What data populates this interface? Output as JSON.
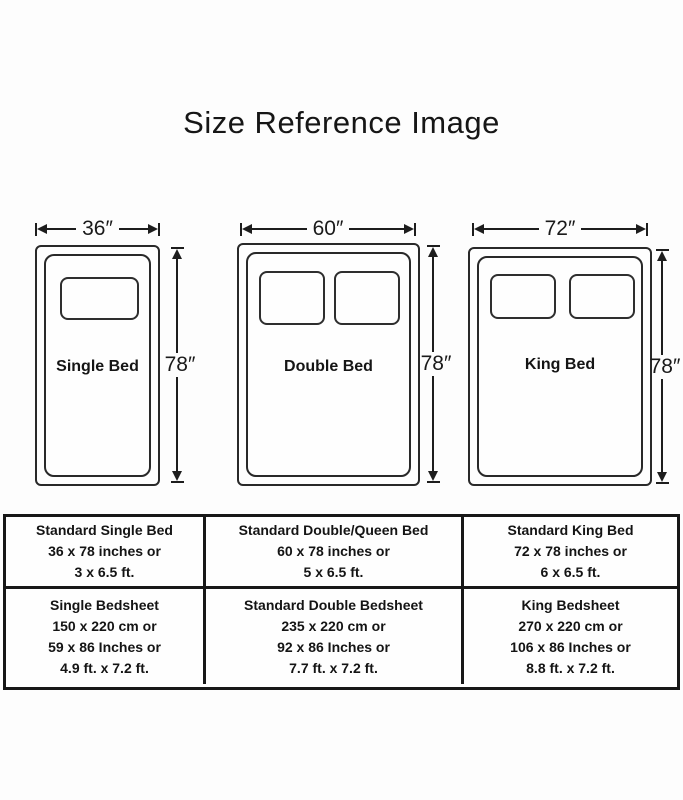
{
  "title": "Size Reference Image",
  "beds": [
    {
      "name": "Single Bed",
      "width_label": "36″",
      "height_label": "78″"
    },
    {
      "name": "Double Bed",
      "width_label": "60″",
      "height_label": "78″"
    },
    {
      "name": "King Bed",
      "width_label": "72″",
      "height_label": "78″"
    }
  ],
  "table": {
    "rows": [
      [
        {
          "lines": [
            "Standard Single Bed",
            "36 x 78 inches or",
            "3 x 6.5 ft."
          ]
        },
        {
          "lines": [
            "Standard Double/Queen Bed",
            "60 x 78 inches or",
            "5 x 6.5 ft."
          ]
        },
        {
          "lines": [
            "Standard King Bed",
            "72 x 78 inches or",
            "6 x 6.5 ft."
          ]
        }
      ],
      [
        {
          "lines": [
            "Single Bedsheet",
            "150 x 220 cm or",
            "59 x 86 Inches or",
            "4.9 ft. x 7.2 ft."
          ]
        },
        {
          "lines": [
            "Standard Double Bedsheet",
            "235 x 220 cm or",
            "92 x 86 Inches or",
            "7.7 ft. x 7.2 ft."
          ]
        },
        {
          "lines": [
            "King Bedsheet",
            "270 x 220 cm or",
            "106 x 86 Inches or",
            "8.8 ft. x 7.2 ft."
          ]
        }
      ]
    ]
  },
  "colors": {
    "ink": "#1d1d1d",
    "background": "#fdfdfd"
  }
}
